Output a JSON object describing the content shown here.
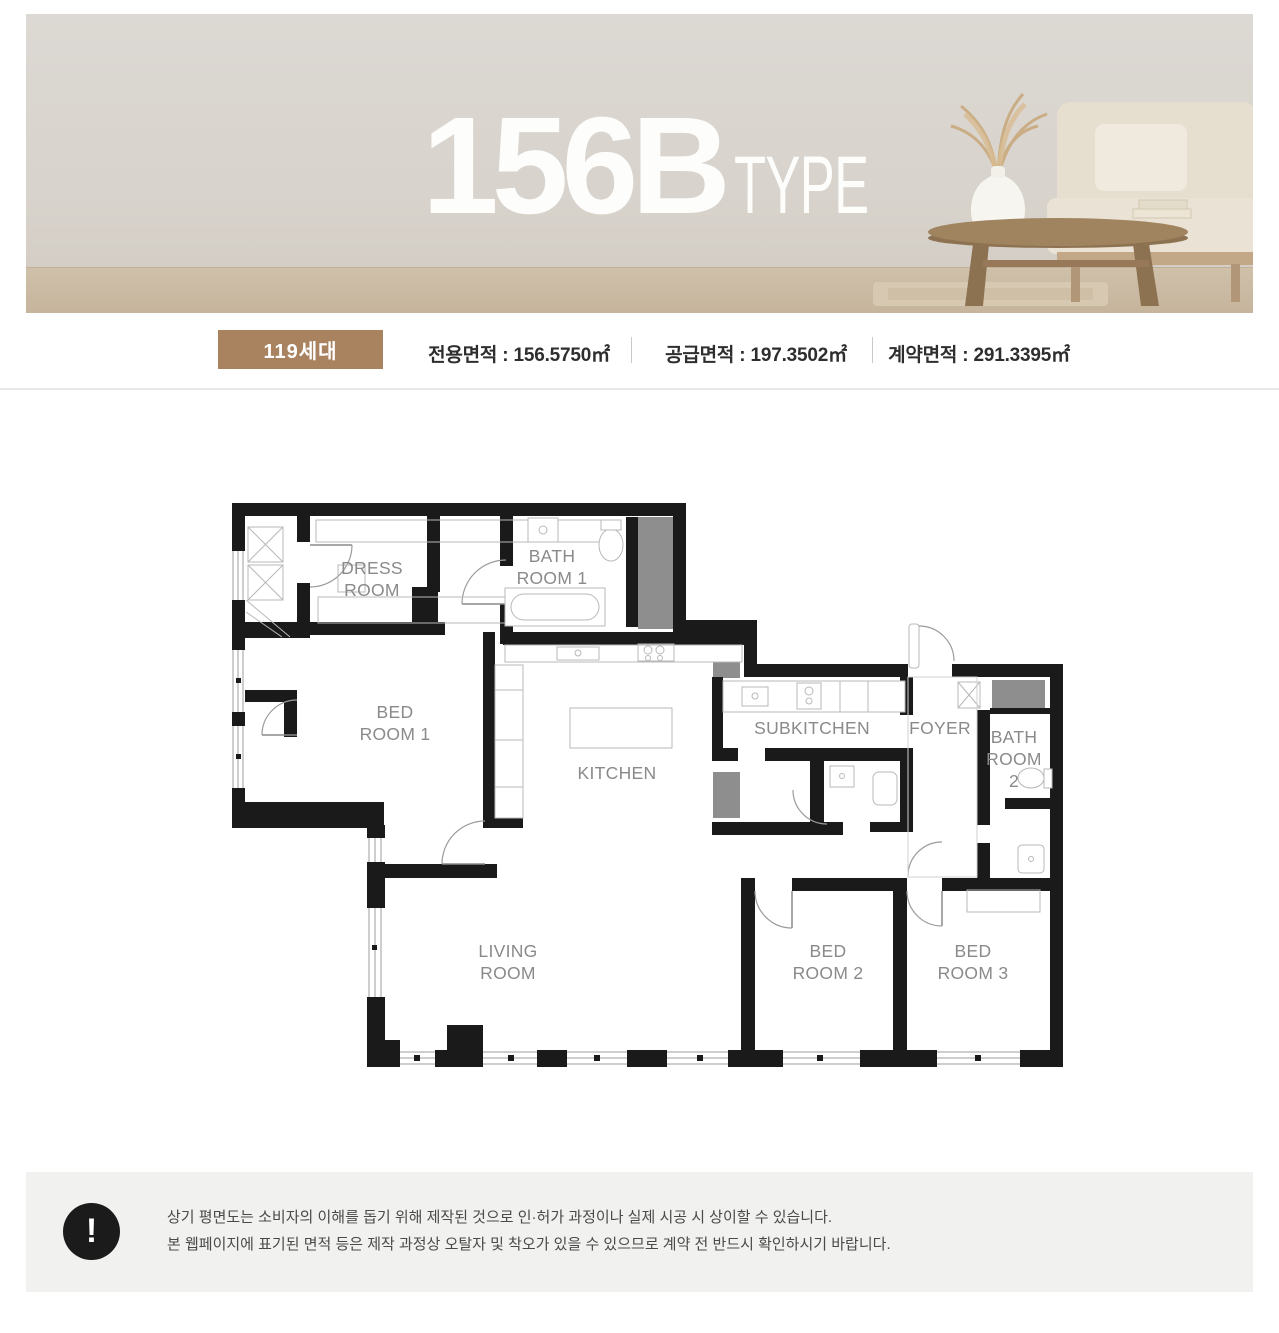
{
  "hero": {
    "title_number": "156B",
    "title_suffix": "TYPE"
  },
  "info_bar": {
    "badge": "119세대",
    "measurements": [
      {
        "label": "전용면적",
        "value": "156.5750㎡",
        "text": "전용면적 : 156.5750㎡"
      },
      {
        "label": "공급면적",
        "value": "197.3502㎡",
        "text": "공급면적 : 197.3502㎡"
      },
      {
        "label": "계약면적",
        "value": "291.3395㎡",
        "text": "계약면적 : 291.3395㎡"
      }
    ]
  },
  "floor_plan": {
    "rooms": [
      "DRESS ROOM",
      "BATH ROOM 1",
      "BED ROOM 1",
      "KITCHEN",
      "SUBKITCHEN",
      "FOYER",
      "BATH ROOM 2",
      "LIVING ROOM",
      "BED ROOM 2",
      "BED ROOM 3"
    ],
    "labels": [
      {
        "text": "DRESS",
        "x": 372,
        "y": 574
      },
      {
        "text": "ROOM",
        "x": 372,
        "y": 596
      },
      {
        "text": "BATH",
        "x": 552,
        "y": 562
      },
      {
        "text": "ROOM 1",
        "x": 552,
        "y": 584
      },
      {
        "text": "BED",
        "x": 395,
        "y": 718
      },
      {
        "text": "ROOM 1",
        "x": 395,
        "y": 740
      },
      {
        "text": "KITCHEN",
        "x": 617,
        "y": 779
      },
      {
        "text": "SUBKITCHEN",
        "x": 812,
        "y": 734
      },
      {
        "text": "FOYER",
        "x": 940,
        "y": 734
      },
      {
        "text": "BATH",
        "x": 1014,
        "y": 743
      },
      {
        "text": "ROOM",
        "x": 1014,
        "y": 765
      },
      {
        "text": "2",
        "x": 1014,
        "y": 787
      },
      {
        "text": "LIVING",
        "x": 508,
        "y": 957
      },
      {
        "text": "ROOM",
        "x": 508,
        "y": 979
      },
      {
        "text": "BED",
        "x": 828,
        "y": 957
      },
      {
        "text": "ROOM 2",
        "x": 828,
        "y": 979
      },
      {
        "text": "BED",
        "x": 973,
        "y": 957
      },
      {
        "text": "ROOM 3",
        "x": 973,
        "y": 979
      }
    ]
  },
  "notice": {
    "icon": "!",
    "lines": [
      "상기 평면도는 소비자의 이해를 돕기 위해 제작된 것으로 인·허가 과정이나 실제 시공 시 상이할 수 있습니다.",
      "본 웹페이지에 표기된 면적 등은 제작 과정상 오탈자 및 착오가 있을 수 있으므로 계약 전 반드시 확인하시기 바랍니다."
    ]
  }
}
